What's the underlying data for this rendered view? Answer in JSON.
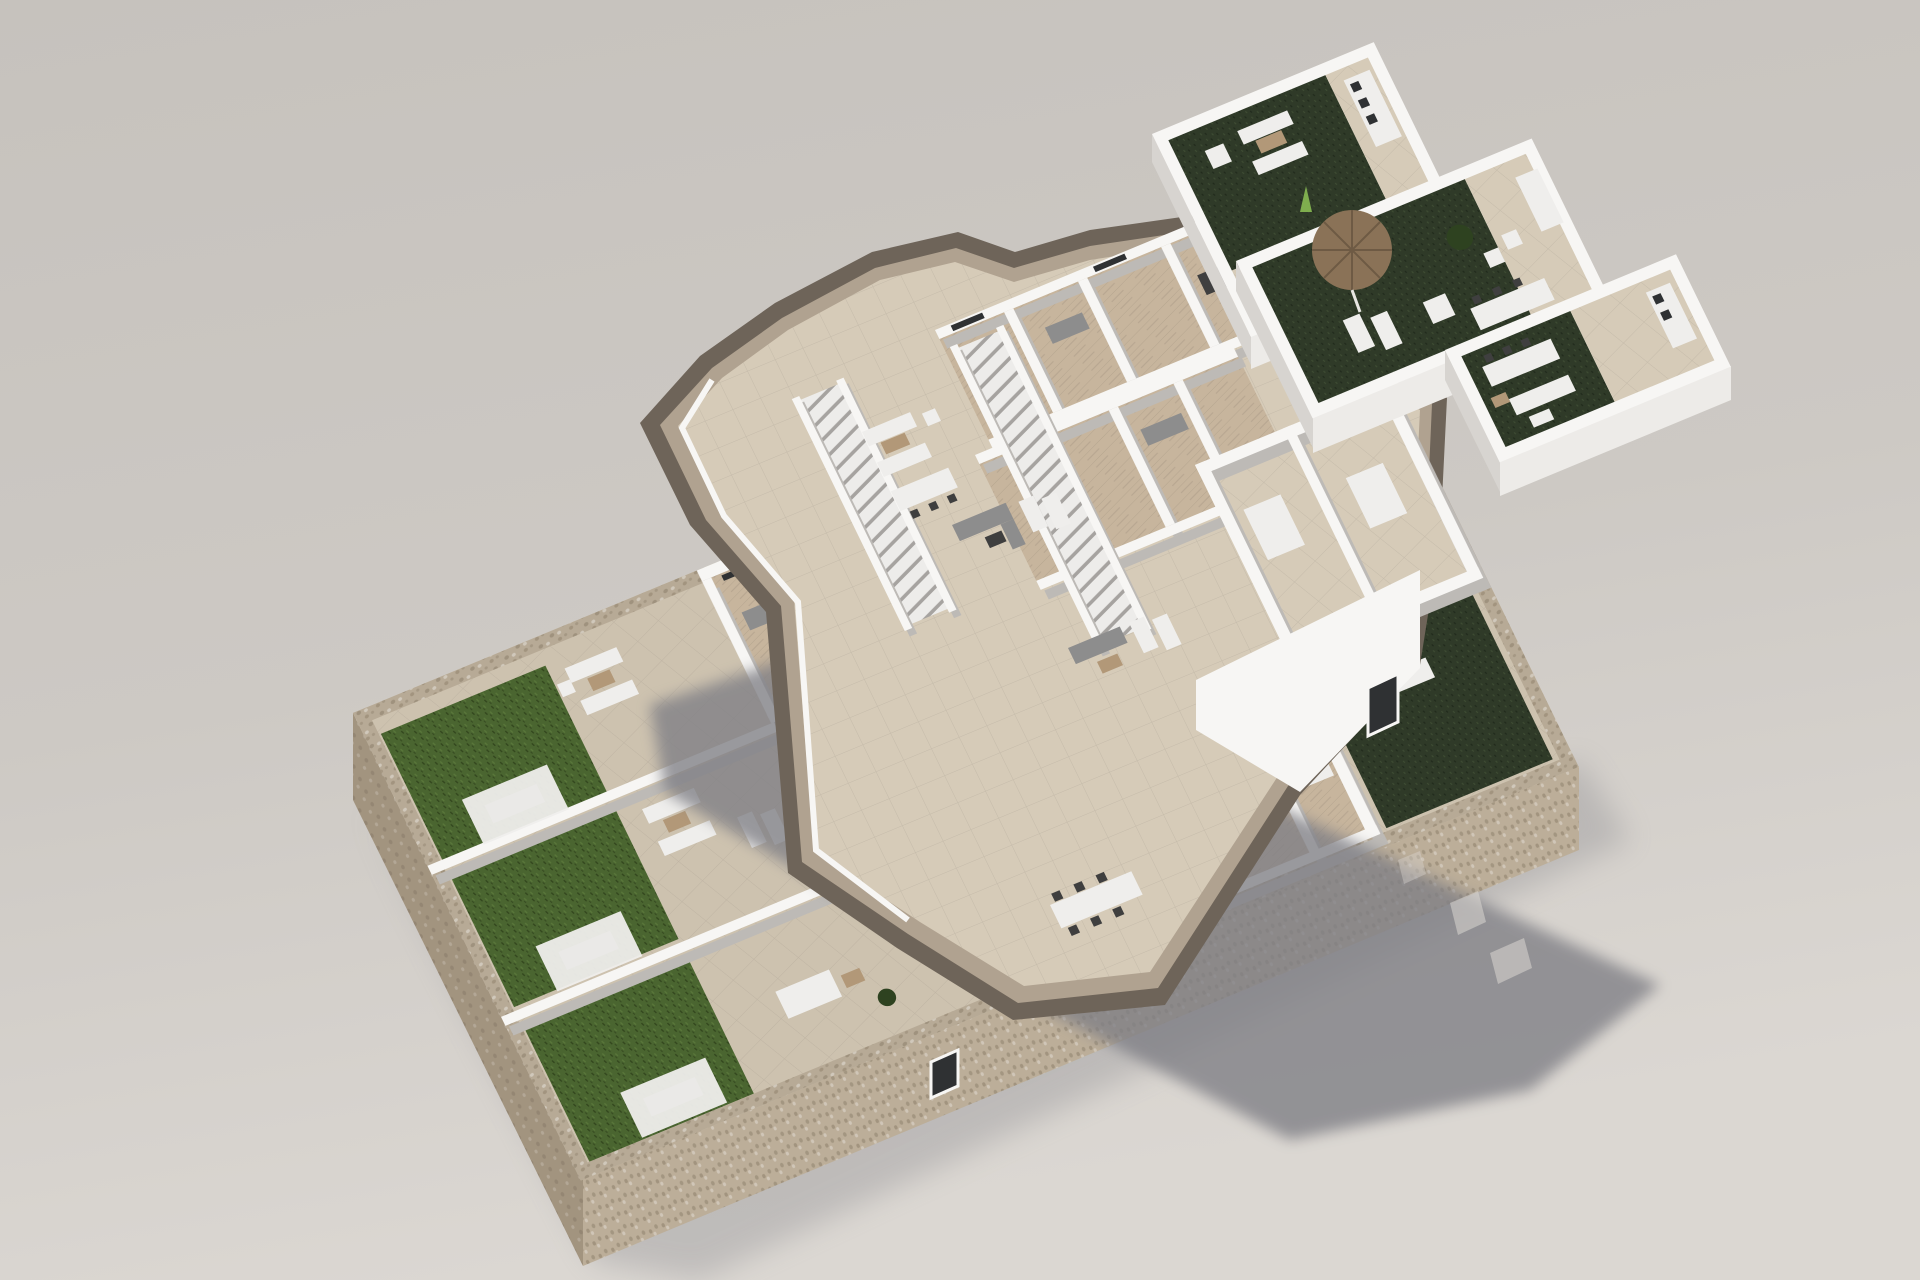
{
  "scene": {
    "type": "architectural-3d-exploded-floorplan-render",
    "background": "plain studio gray",
    "levels": [
      {
        "id": "ground-floor",
        "gardens": 3,
        "lawn_canopies": 3,
        "stone_perimeter": true,
        "wide_stair": 1
      },
      {
        "id": "first-floor",
        "floating": true,
        "long_staircases": 2,
        "terraces": 3,
        "slab_edge": "jagged taupe band"
      },
      {
        "id": "roof-level",
        "floating": true,
        "terraces": 3,
        "parasols": 1,
        "turf_areas": 4
      }
    ],
    "shadow": {
      "cast_by": "first-floor",
      "light_slots": 4
    }
  },
  "colors": {
    "bg_top": "#c6c2bd",
    "bg_mid": "#cdc9c4",
    "bg_bottom": "#dbd7d2",
    "shadow": "#7f7f85",
    "stone_top": "#b7aa96",
    "stone_lit": "#bcae99",
    "stone_shade": "#a2947f",
    "stone_dark": "#8a7d6a",
    "lawn": "#4a6530",
    "lawn_dark": "#33471e",
    "lawn_light": "#5d7a3c",
    "turf": "#2f3a28",
    "turf_light": "#3e4c33",
    "tile": "#d6cbb8",
    "tile_ground": "#cdc2af",
    "wood": "#c7b59d",
    "wall_top": "#f7f6f4",
    "wall_lit": "#edebe8",
    "wall_mid": "#d7d4d0",
    "wall_shade": "#bdbab6",
    "slab_dark": "#6e6459",
    "slab_light": "#b0a290",
    "stair_tread": "#edecea",
    "stair_gap": "#a6a3a0",
    "drive": "#9a9896",
    "furn_dark": "#3f3f3f",
    "furn_gray": "#8d8d8d",
    "furn_white": "#efeeec",
    "furn_wood": "#b29878",
    "parasol": "#8a7257",
    "glass_dark": "#2f3133",
    "plant": "#2e4220"
  }
}
